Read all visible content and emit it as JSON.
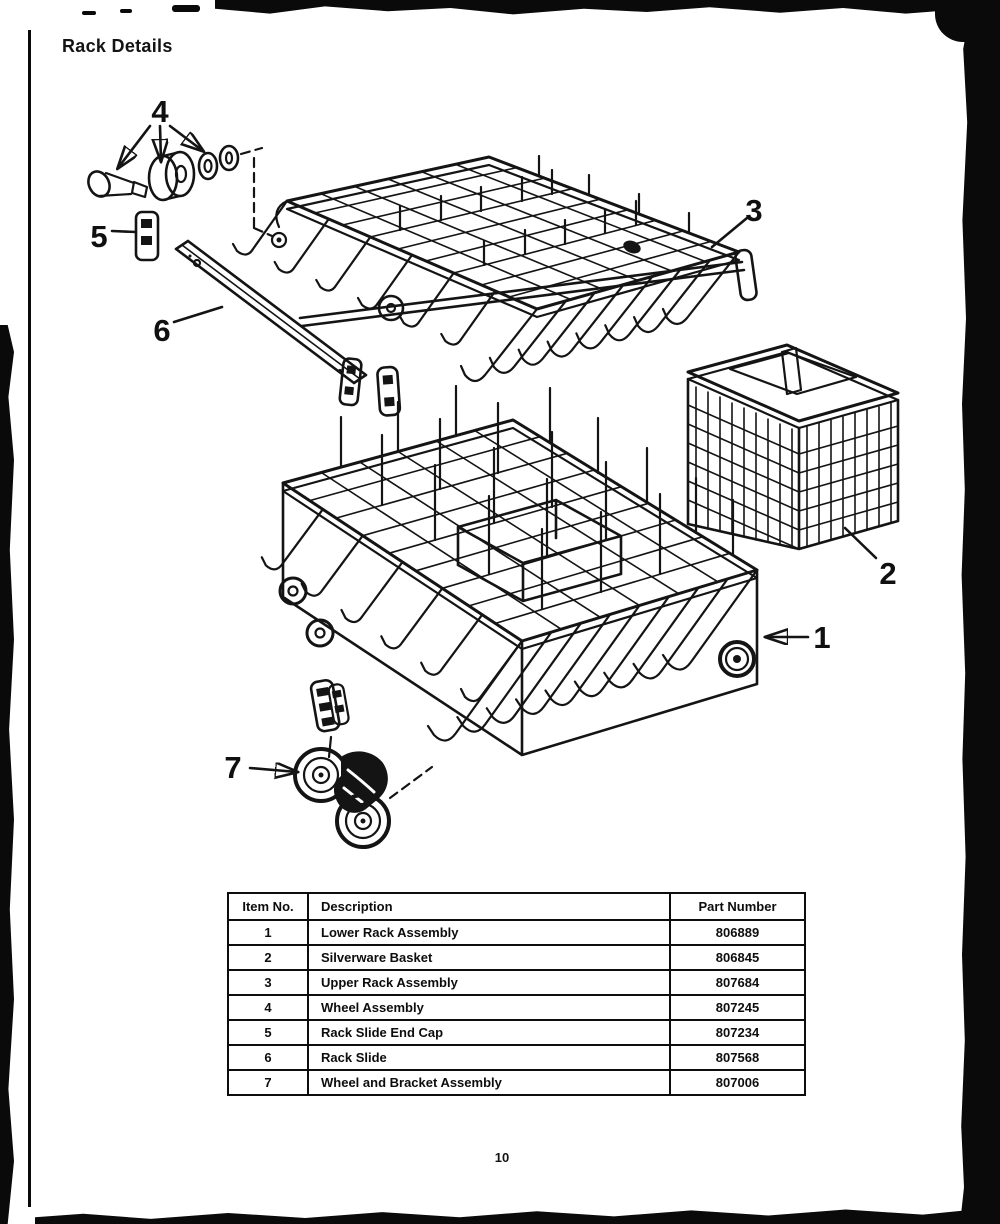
{
  "page": {
    "title": "Rack Details",
    "page_number": "10"
  },
  "colors": {
    "ink": "#141414",
    "paper": "#ffffff"
  },
  "table": {
    "headers": {
      "item": "Item No.",
      "description": "Description",
      "part": "Part Number"
    },
    "rows": [
      {
        "item": "1",
        "description": "Lower Rack Assembly",
        "part": "806889"
      },
      {
        "item": "2",
        "description": "Silverware Basket",
        "part": "806845"
      },
      {
        "item": "3",
        "description": "Upper Rack Assembly",
        "part": "807684"
      },
      {
        "item": "4",
        "description": "Wheel Assembly",
        "part": "807245"
      },
      {
        "item": "5",
        "description": "Rack Slide End Cap",
        "part": "807234"
      },
      {
        "item": "6",
        "description": "Rack Slide",
        "part": "807568"
      },
      {
        "item": "7",
        "description": "Wheel and Bracket Assembly",
        "part": "807006"
      }
    ]
  },
  "diagram": {
    "callouts": [
      {
        "label": "1"
      },
      {
        "label": "2"
      },
      {
        "label": "3"
      },
      {
        "label": "4"
      },
      {
        "label": "5"
      },
      {
        "label": "6"
      },
      {
        "label": "7"
      }
    ]
  }
}
